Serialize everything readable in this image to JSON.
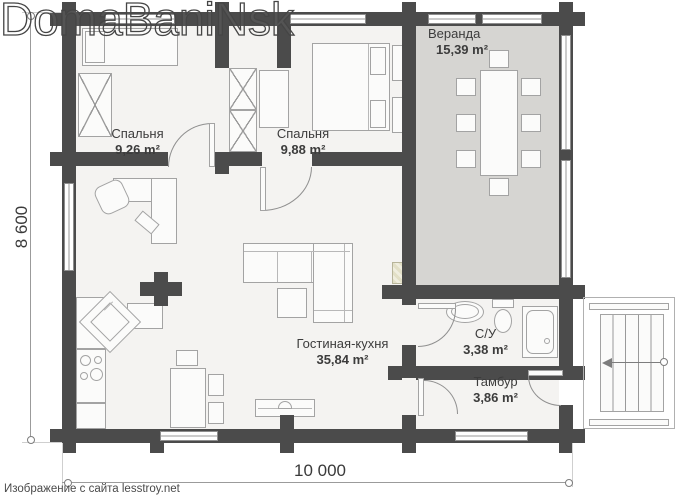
{
  "watermark": "DomaBaniNsk",
  "attribution": "Изображение с сайта lesstroy.net",
  "dimensions": {
    "bottom": "10 000",
    "left": "8 600"
  },
  "rooms": {
    "bedroom1": {
      "name": "Спальня",
      "area": "9,26 m²"
    },
    "bedroom2": {
      "name": "Спальня",
      "area": "9,88 m²"
    },
    "veranda": {
      "name": "Веранда",
      "area": "15,39 m²"
    },
    "living": {
      "name": "Гостиная-кухня",
      "area": "35,84 m²"
    },
    "bathroom": {
      "name": "С/У",
      "area": "3,38 m²"
    },
    "tambour": {
      "name": "Тамбур",
      "area": "3,86 m²"
    }
  },
  "colors": {
    "wall": "#4b4b4b",
    "floor": "#f4f3f1",
    "veranda_floor": "#d6d5d2"
  }
}
